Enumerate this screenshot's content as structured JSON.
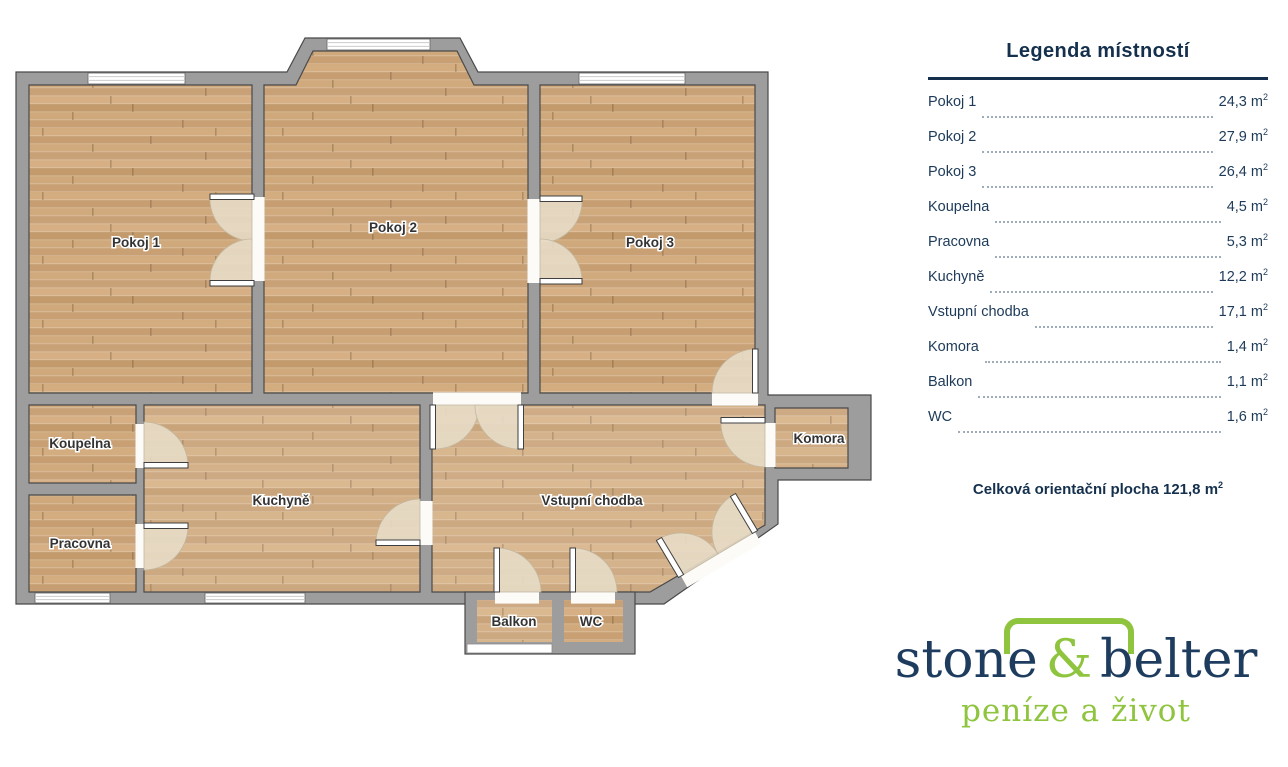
{
  "plan": {
    "rooms": [
      {
        "label": "Pokoj 1"
      },
      {
        "label": "Pokoj 2"
      },
      {
        "label": "Pokoj 3"
      },
      {
        "label": "Koupelna"
      },
      {
        "label": "Pracovna"
      },
      {
        "label": "Kuchyně"
      },
      {
        "label": "Vstupní chodba"
      },
      {
        "label": "Komora"
      },
      {
        "label": "Balkon"
      },
      {
        "label": "WC"
      }
    ]
  },
  "legend": {
    "title": "Legenda místností",
    "unit_base": "m",
    "unit_exp": "2",
    "rows": [
      {
        "label": "Pokoj 1",
        "value": "24,3"
      },
      {
        "label": "Pokoj 2",
        "value": "27,9"
      },
      {
        "label": "Pokoj 3",
        "value": "26,4"
      },
      {
        "label": "Koupelna",
        "value": "4,5"
      },
      {
        "label": "Pracovna",
        "value": "5,3"
      },
      {
        "label": "Kuchyně",
        "value": "12,2"
      },
      {
        "label": "Vstupní chodba",
        "value": "17,1"
      },
      {
        "label": "Komora",
        "value": "1,4"
      },
      {
        "label": "Balkon",
        "value": "1,1"
      },
      {
        "label": "WC",
        "value": "1,6"
      }
    ],
    "total_label": "Celková orientační plocha",
    "total_value": "121,8"
  },
  "logo": {
    "name_part1": "stone",
    "name_amp": "&",
    "name_part2": "belter",
    "tagline": "peníze a život"
  },
  "colors": {
    "navy": "#14304d",
    "green": "#8fc43e",
    "wall_gray": "#9d9d9d",
    "wall_outline": "#4a4a4a",
    "floor_wood": "#cda67a",
    "door_arc": "#e7dcc7"
  }
}
